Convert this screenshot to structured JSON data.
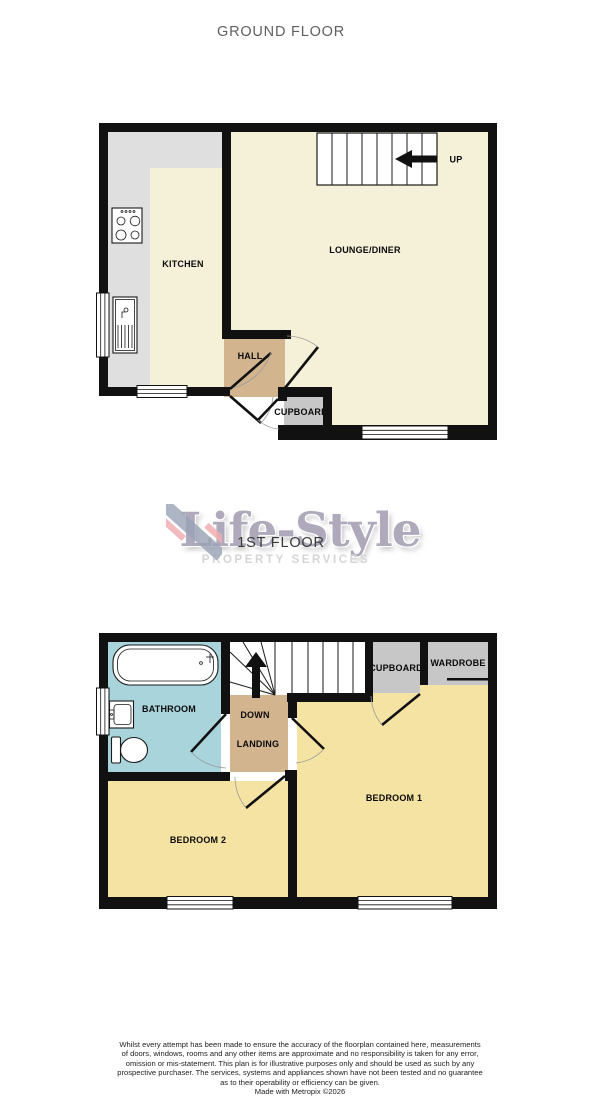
{
  "headings": {
    "ground_floor": "GROUND FLOOR",
    "first_floor": "1ST FLOOR"
  },
  "watermark": {
    "brand_name": "Life-Style",
    "tagline": "PROPERTY SERVICES"
  },
  "ground_floor": {
    "labels": {
      "kitchen": "KITCHEN",
      "lounge_diner": "LOUNGE/DINER",
      "hall": "HALL",
      "cupboard": "CUPBOARD",
      "stairs_direction": "UP"
    }
  },
  "first_floor": {
    "labels": {
      "bathroom": "BATHROOM",
      "landing": "LANDING",
      "down": "DOWN",
      "cupboard": "CUPBOARD",
      "wardrobe": "WARDROBE",
      "bedroom1": "BEDROOM 1",
      "bedroom2": "BEDROOM 2"
    }
  },
  "footer": {
    "disclaimer_lines": [
      "Whilst every attempt has been made to ensure the accuracy of the floorplan contained here, measurements",
      "of doors, windows, rooms and any other items are approximate and no responsibility is taken for any error,",
      "omission or mis-statement. This plan is for illustrative purposes only and should be used as such by any",
      "prospective purchaser. The services, systems and appliances shown have not been tested and no guarantee",
      "as to their operability or efficiency can be given."
    ],
    "credit": "Made with Metropix ©2026"
  },
  "colors": {
    "wall": "#111111",
    "cream": "#F5F0D8",
    "bedroom": "#F5E3A3",
    "hall": "#D2B48F",
    "bath": "#A9D4DC",
    "counter": "#DFDFDF",
    "storage": "#C7C7C7",
    "brand_purple": "#7F7896",
    "brand_pink": "#F1AEB3",
    "brand_blue": "#99A2B6"
  }
}
